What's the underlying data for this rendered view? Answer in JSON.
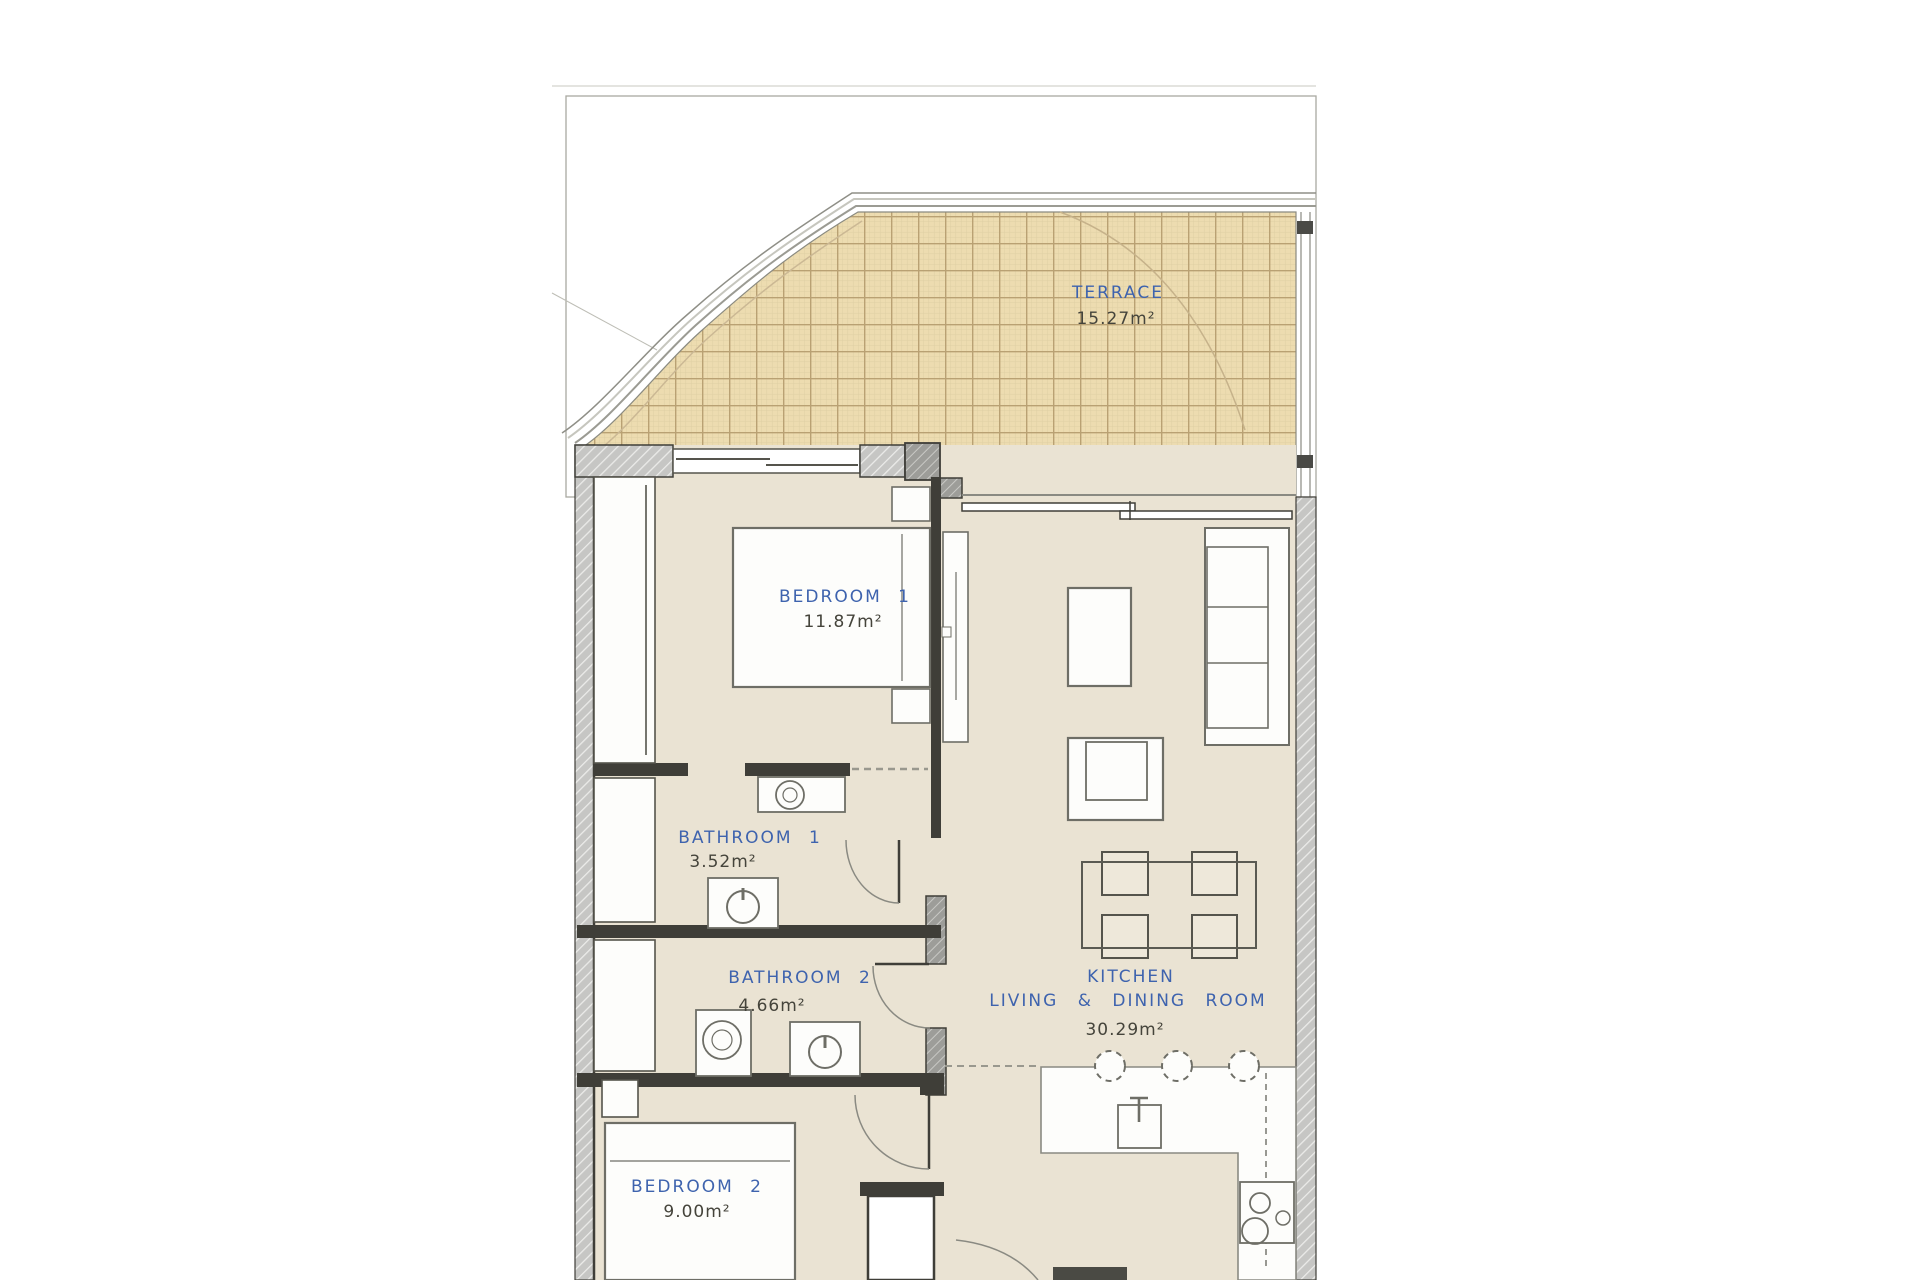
{
  "rooms": {
    "terrace": {
      "name": "TERRACE",
      "area": "15.27m²"
    },
    "bedroom1": {
      "name": "BEDROOM 1",
      "area": "11.87m²"
    },
    "bathroom1": {
      "name": "BATHROOM 1",
      "area": "3.52m²"
    },
    "bathroom2": {
      "name": "BATHROOM 2",
      "area": "4.66m²"
    },
    "bedroom2": {
      "name": "BEDROOM 2",
      "area": "9.00m²"
    },
    "kitchen": {
      "name": "KITCHEN",
      "name2": "LIVING & DINING ROOM",
      "area": "30.29m²"
    }
  },
  "colors": {
    "label_blue": "#3e63ae",
    "area_text": "#45443b",
    "terrace_fill": "#eddcb0",
    "terrace_grid": "#b9a173",
    "floor": "#eae3d3",
    "wall_fill": "#c6c6c4",
    "wall_dark": "#3f3e38",
    "line": "#6e6e66"
  }
}
